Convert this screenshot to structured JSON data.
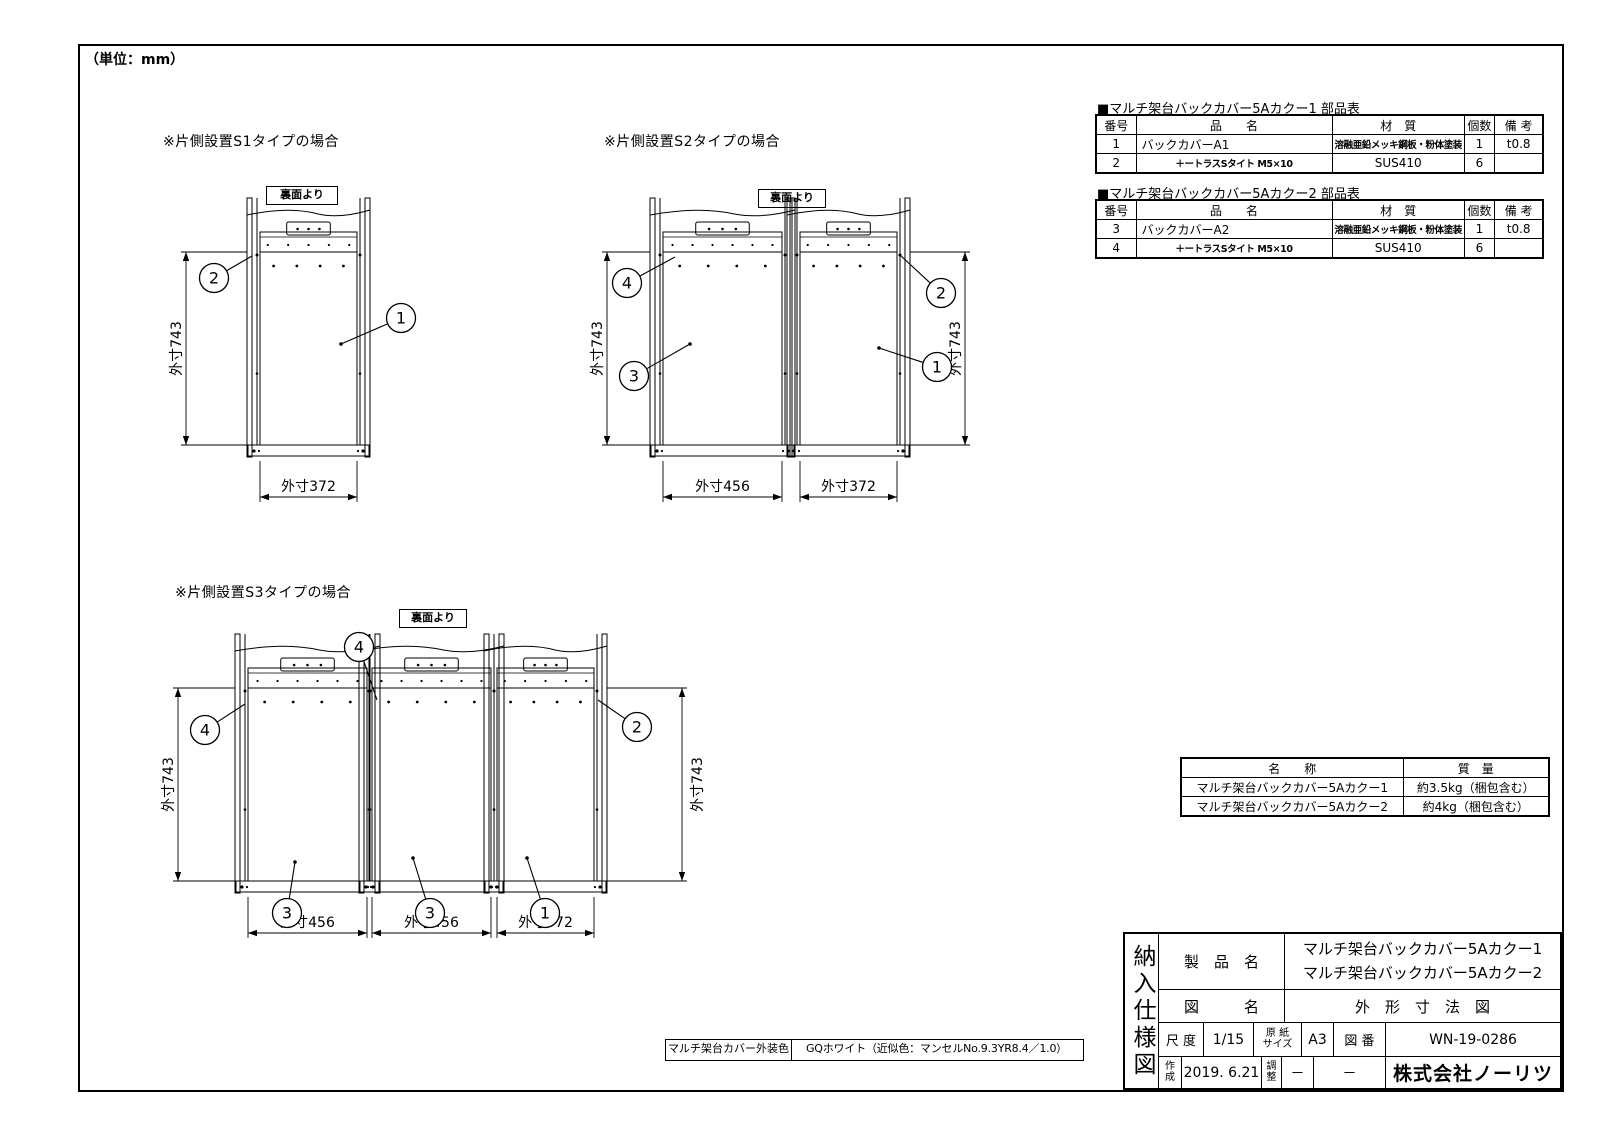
{
  "unit_note": "（単位：mm）",
  "views": [
    {
      "id": "s1",
      "title": "※片側設置S1タイプの場合",
      "rear_label": "裏面より",
      "modules": [
        {
          "mm": 372,
          "dim_label": "外寸372",
          "x": 120
        }
      ],
      "vdims": [
        {
          "x": 46,
          "label": "外寸743",
          "lx": -9,
          "side": "left"
        }
      ],
      "balloons": [
        {
          "n": "2",
          "cx": 74,
          "cy": 98,
          "tx": 112,
          "ty": 76
        },
        {
          "n": "1",
          "cx": 261,
          "cy": 138,
          "tx": 201,
          "ty": 164,
          "dot": true
        }
      ]
    },
    {
      "id": "s2",
      "title": "※片側設置S2タイプの場合",
      "rear_label": "裏面より",
      "modules": [
        {
          "mm": 456,
          "dim_label": "外寸456",
          "x": 88
        },
        {
          "mm": 372,
          "dim_label": "外寸372",
          "x": 225
        }
      ],
      "vdims": [
        {
          "x": 32,
          "label": "外寸743",
          "lx": -9,
          "side": "left"
        },
        {
          "x": 390,
          "label": "外寸743",
          "lx": -9,
          "side": "right"
        }
      ],
      "balloons": [
        {
          "n": "4",
          "cx": 52,
          "cy": 103,
          "tx": 100,
          "ty": 77
        },
        {
          "n": "2",
          "cx": 366,
          "cy": 113,
          "tx": 325,
          "ty": 75
        },
        {
          "n": "3",
          "cx": 59,
          "cy": 196,
          "tx": 115,
          "ty": 164,
          "dot": true
        },
        {
          "n": "1",
          "cx": 362,
          "cy": 187,
          "tx": 304,
          "ty": 168,
          "dot": true
        }
      ]
    },
    {
      "id": "s3",
      "title": "※片側設置S3タイプの場合",
      "rear_label": "裏面より",
      "yoff": 16,
      "modules": [
        {
          "mm": 456,
          "dim_label": "外寸456",
          "x": 98
        },
        {
          "mm": 456,
          "dim_label": "外寸456",
          "x": 222
        },
        {
          "mm": 372,
          "dim_label": "外寸372",
          "x": 347
        }
      ],
      "vdims": [
        {
          "x": 28,
          "label": "外寸743",
          "lx": -9,
          "side": "left"
        },
        {
          "x": 532,
          "label": "外寸743",
          "lx": 16,
          "side": "right"
        }
      ],
      "balloons": [
        {
          "n": "4",
          "cx": 209,
          "cy": 47,
          "tx": 227,
          "ty": 100
        },
        {
          "n": "4",
          "cx": 55,
          "cy": 130,
          "tx": 95,
          "ty": 104
        },
        {
          "n": "2",
          "cx": 487,
          "cy": 127,
          "tx": 448,
          "ty": 100
        },
        {
          "n": "3",
          "cx": 137,
          "cy": 313,
          "tx": 145,
          "ty": 262,
          "dot": true
        },
        {
          "n": "3",
          "cx": 280,
          "cy": 313,
          "tx": 263,
          "ty": 258,
          "dot": true
        },
        {
          "n": "1",
          "cx": 395,
          "cy": 313,
          "tx": 377,
          "ty": 258,
          "dot": true
        }
      ]
    }
  ],
  "parts_tables": [
    {
      "title": "■マルチ架台バックカバー5Aカクー1 部品表",
      "headers": [
        "番号",
        "品　　名",
        "材　質",
        "個数",
        "備 考"
      ],
      "rows": [
        [
          "1",
          "バックカバーA1",
          "溶融亜鉛メッキ鋼板・粉体塗装",
          "1",
          "t0.8"
        ],
        [
          "2",
          "＋ートラスSタイト  M5×10",
          "SUS410",
          "6",
          ""
        ]
      ]
    },
    {
      "title": "■マルチ架台バックカバー5Aカクー2 部品表",
      "headers": [
        "番号",
        "品　　名",
        "材　質",
        "個数",
        "備 考"
      ],
      "rows": [
        [
          "3",
          "バックカバーA2",
          "溶融亜鉛メッキ鋼板・粉体塗装",
          "1",
          "t0.8"
        ],
        [
          "4",
          "＋ートラスSタイト  M5×10",
          "SUS410",
          "6",
          ""
        ]
      ]
    }
  ],
  "mass_table": {
    "headers": [
      "名　　称",
      "質　量"
    ],
    "rows": [
      [
        "マルチ架台バックカバー5Aカクー1",
        "約3.5kg（梱包含む）"
      ],
      [
        "マルチ架台バックカバー5Aカクー2",
        "約4kg（梱包含む）"
      ]
    ]
  },
  "color_note": {
    "label": "マルチ架台カバー外装色",
    "value": "GQホワイト（近似色：マンセルNo.9.3YR8.4／1.0）"
  },
  "title_block": {
    "doc_type_vertical": "納入仕様図",
    "product_label": "製　品　名",
    "product_names": [
      "マルチ架台バックカバー5Aカクー1",
      "マルチ架台バックカバー5Aカクー2"
    ],
    "drawing_label": "図　　　名",
    "drawing_name": "外　形　寸　法　図",
    "scale_label": "尺 度",
    "scale_value": "1/15",
    "paper_label": "原 紙\nサイズ",
    "paper_value": "A3",
    "number_label": "図 番",
    "number_value": "WN-19-0286",
    "created_label": "作\n成",
    "created_value": "2019. 6.21",
    "adjust_label": "調\n整",
    "adjust_value": "－",
    "dash": "－",
    "company": "株式会社ノーリツ"
  },
  "line_color": "#000000"
}
